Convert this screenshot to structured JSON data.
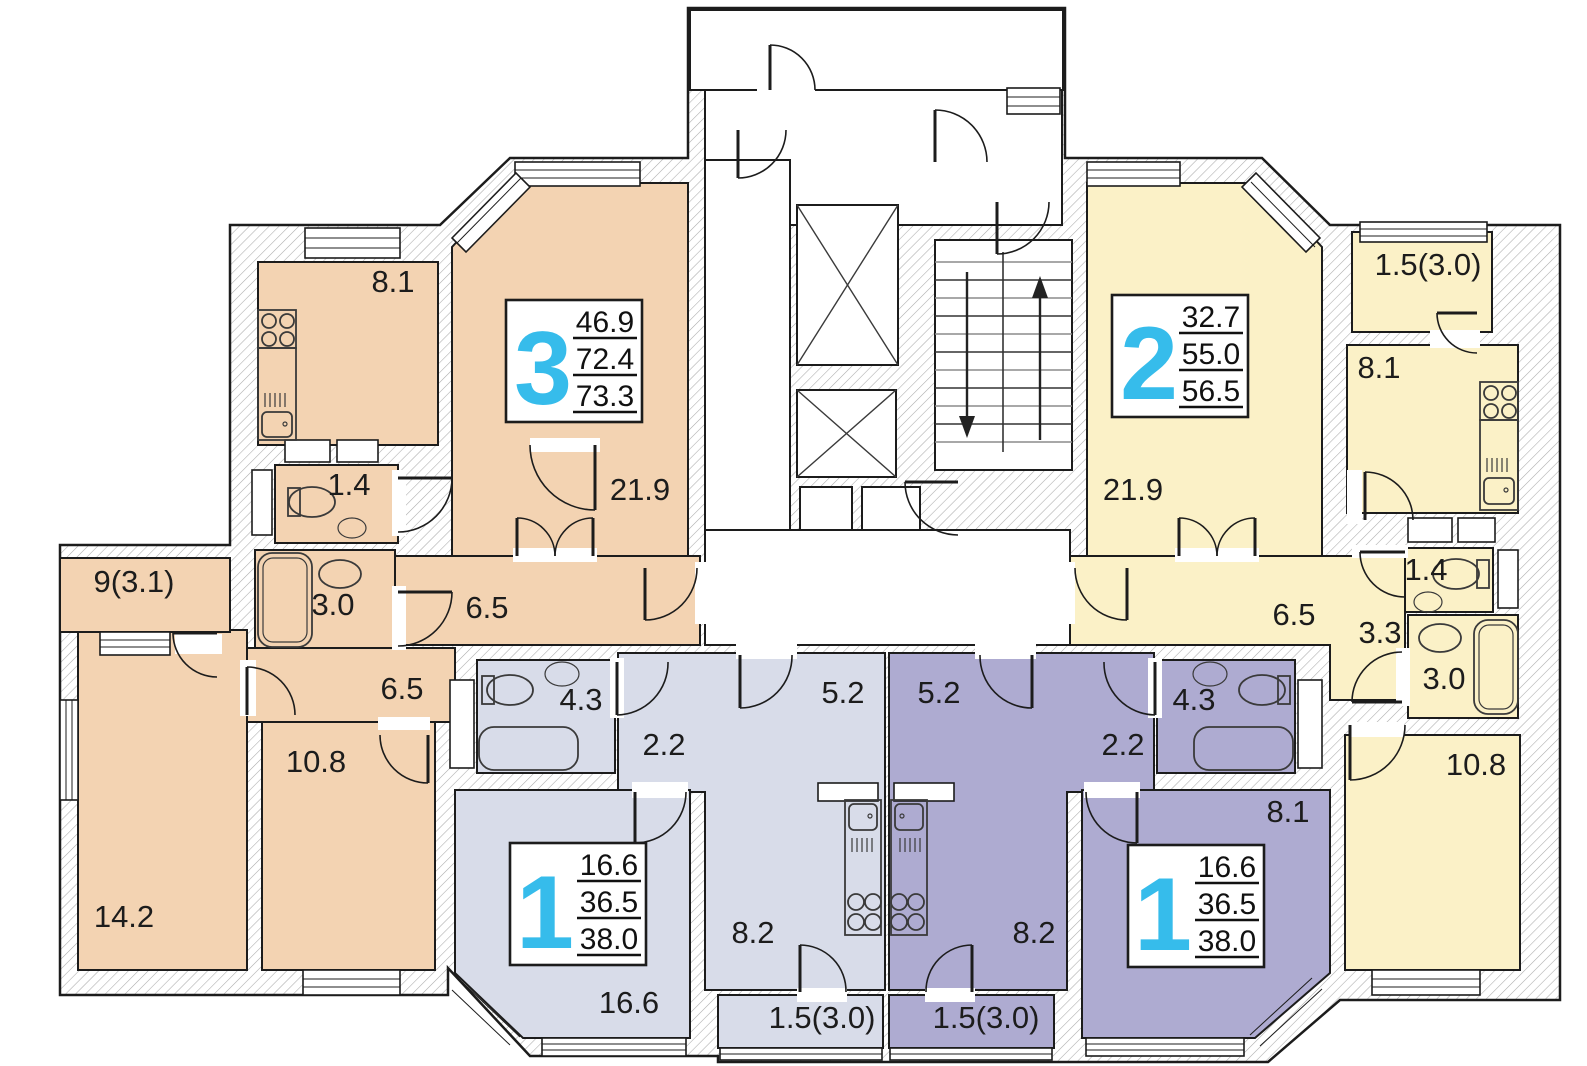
{
  "plan_title": "Typical floor plan with four apartments",
  "colors": {
    "apartment_3_room": "#F3D3B2",
    "apartment_2_room": "#FBF1C7",
    "apartment_1_room_left": "#D8DCE9",
    "apartment_1_room_right": "#AEABD1",
    "apartment_number_accent": "#36BCEB",
    "wall_hatch": "#ABABAB",
    "line": "#1c1c1c"
  },
  "apartments": [
    {
      "id": "apartment-3-room",
      "number": "3",
      "areas": [
        "46.9",
        "72.4",
        "73.3"
      ],
      "rooms": [
        {
          "name": "kitchen",
          "label": "8.1"
        },
        {
          "name": "living-room",
          "label": "21.9"
        },
        {
          "name": "wc",
          "label": "1.4"
        },
        {
          "name": "bathroom",
          "label": "3.0"
        },
        {
          "name": "hall",
          "label": "6.5"
        },
        {
          "name": "balcony",
          "label": "9(3.1)"
        },
        {
          "name": "hall-2",
          "label": "6.5"
        },
        {
          "name": "bedroom",
          "label": "10.8"
        },
        {
          "name": "bedroom-2",
          "label": "14.2"
        }
      ]
    },
    {
      "id": "apartment-2-room",
      "number": "2",
      "areas": [
        "32.7",
        "55.0",
        "56.5"
      ],
      "rooms": [
        {
          "name": "living-room",
          "label": "21.9"
        },
        {
          "name": "balcony",
          "label": "1.5(3.0)"
        },
        {
          "name": "kitchen",
          "label": "8.1"
        },
        {
          "name": "wc",
          "label": "1.4"
        },
        {
          "name": "hall",
          "label": "6.5"
        },
        {
          "name": "hall-2",
          "label": "3.3"
        },
        {
          "name": "bathroom",
          "label": "3.0"
        },
        {
          "name": "bedroom",
          "label": "10.8"
        }
      ]
    },
    {
      "id": "apartment-1-room-left",
      "number": "1",
      "areas": [
        "16.6",
        "36.5",
        "38.0"
      ],
      "rooms": [
        {
          "name": "bathroom",
          "label": "4.3"
        },
        {
          "name": "hall",
          "label": "2.2"
        },
        {
          "name": "hall-2",
          "label": "5.2"
        },
        {
          "name": "living-room",
          "label": "16.6"
        },
        {
          "name": "kitchen",
          "label": "8.2"
        },
        {
          "name": "balcony",
          "label": "1.5(3.0)"
        }
      ]
    },
    {
      "id": "apartment-1-room-right",
      "number": "1",
      "areas": [
        "16.6",
        "36.5",
        "38.0"
      ],
      "rooms": [
        {
          "name": "hall",
          "label": "5.2"
        },
        {
          "name": "hall-2",
          "label": "2.2"
        },
        {
          "name": "bathroom",
          "label": "4.3"
        },
        {
          "name": "kitchen",
          "label": "8.2"
        },
        {
          "name": "corner",
          "label": "8.1"
        },
        {
          "name": "balcony",
          "label": "1.5(3.0)"
        }
      ]
    }
  ]
}
